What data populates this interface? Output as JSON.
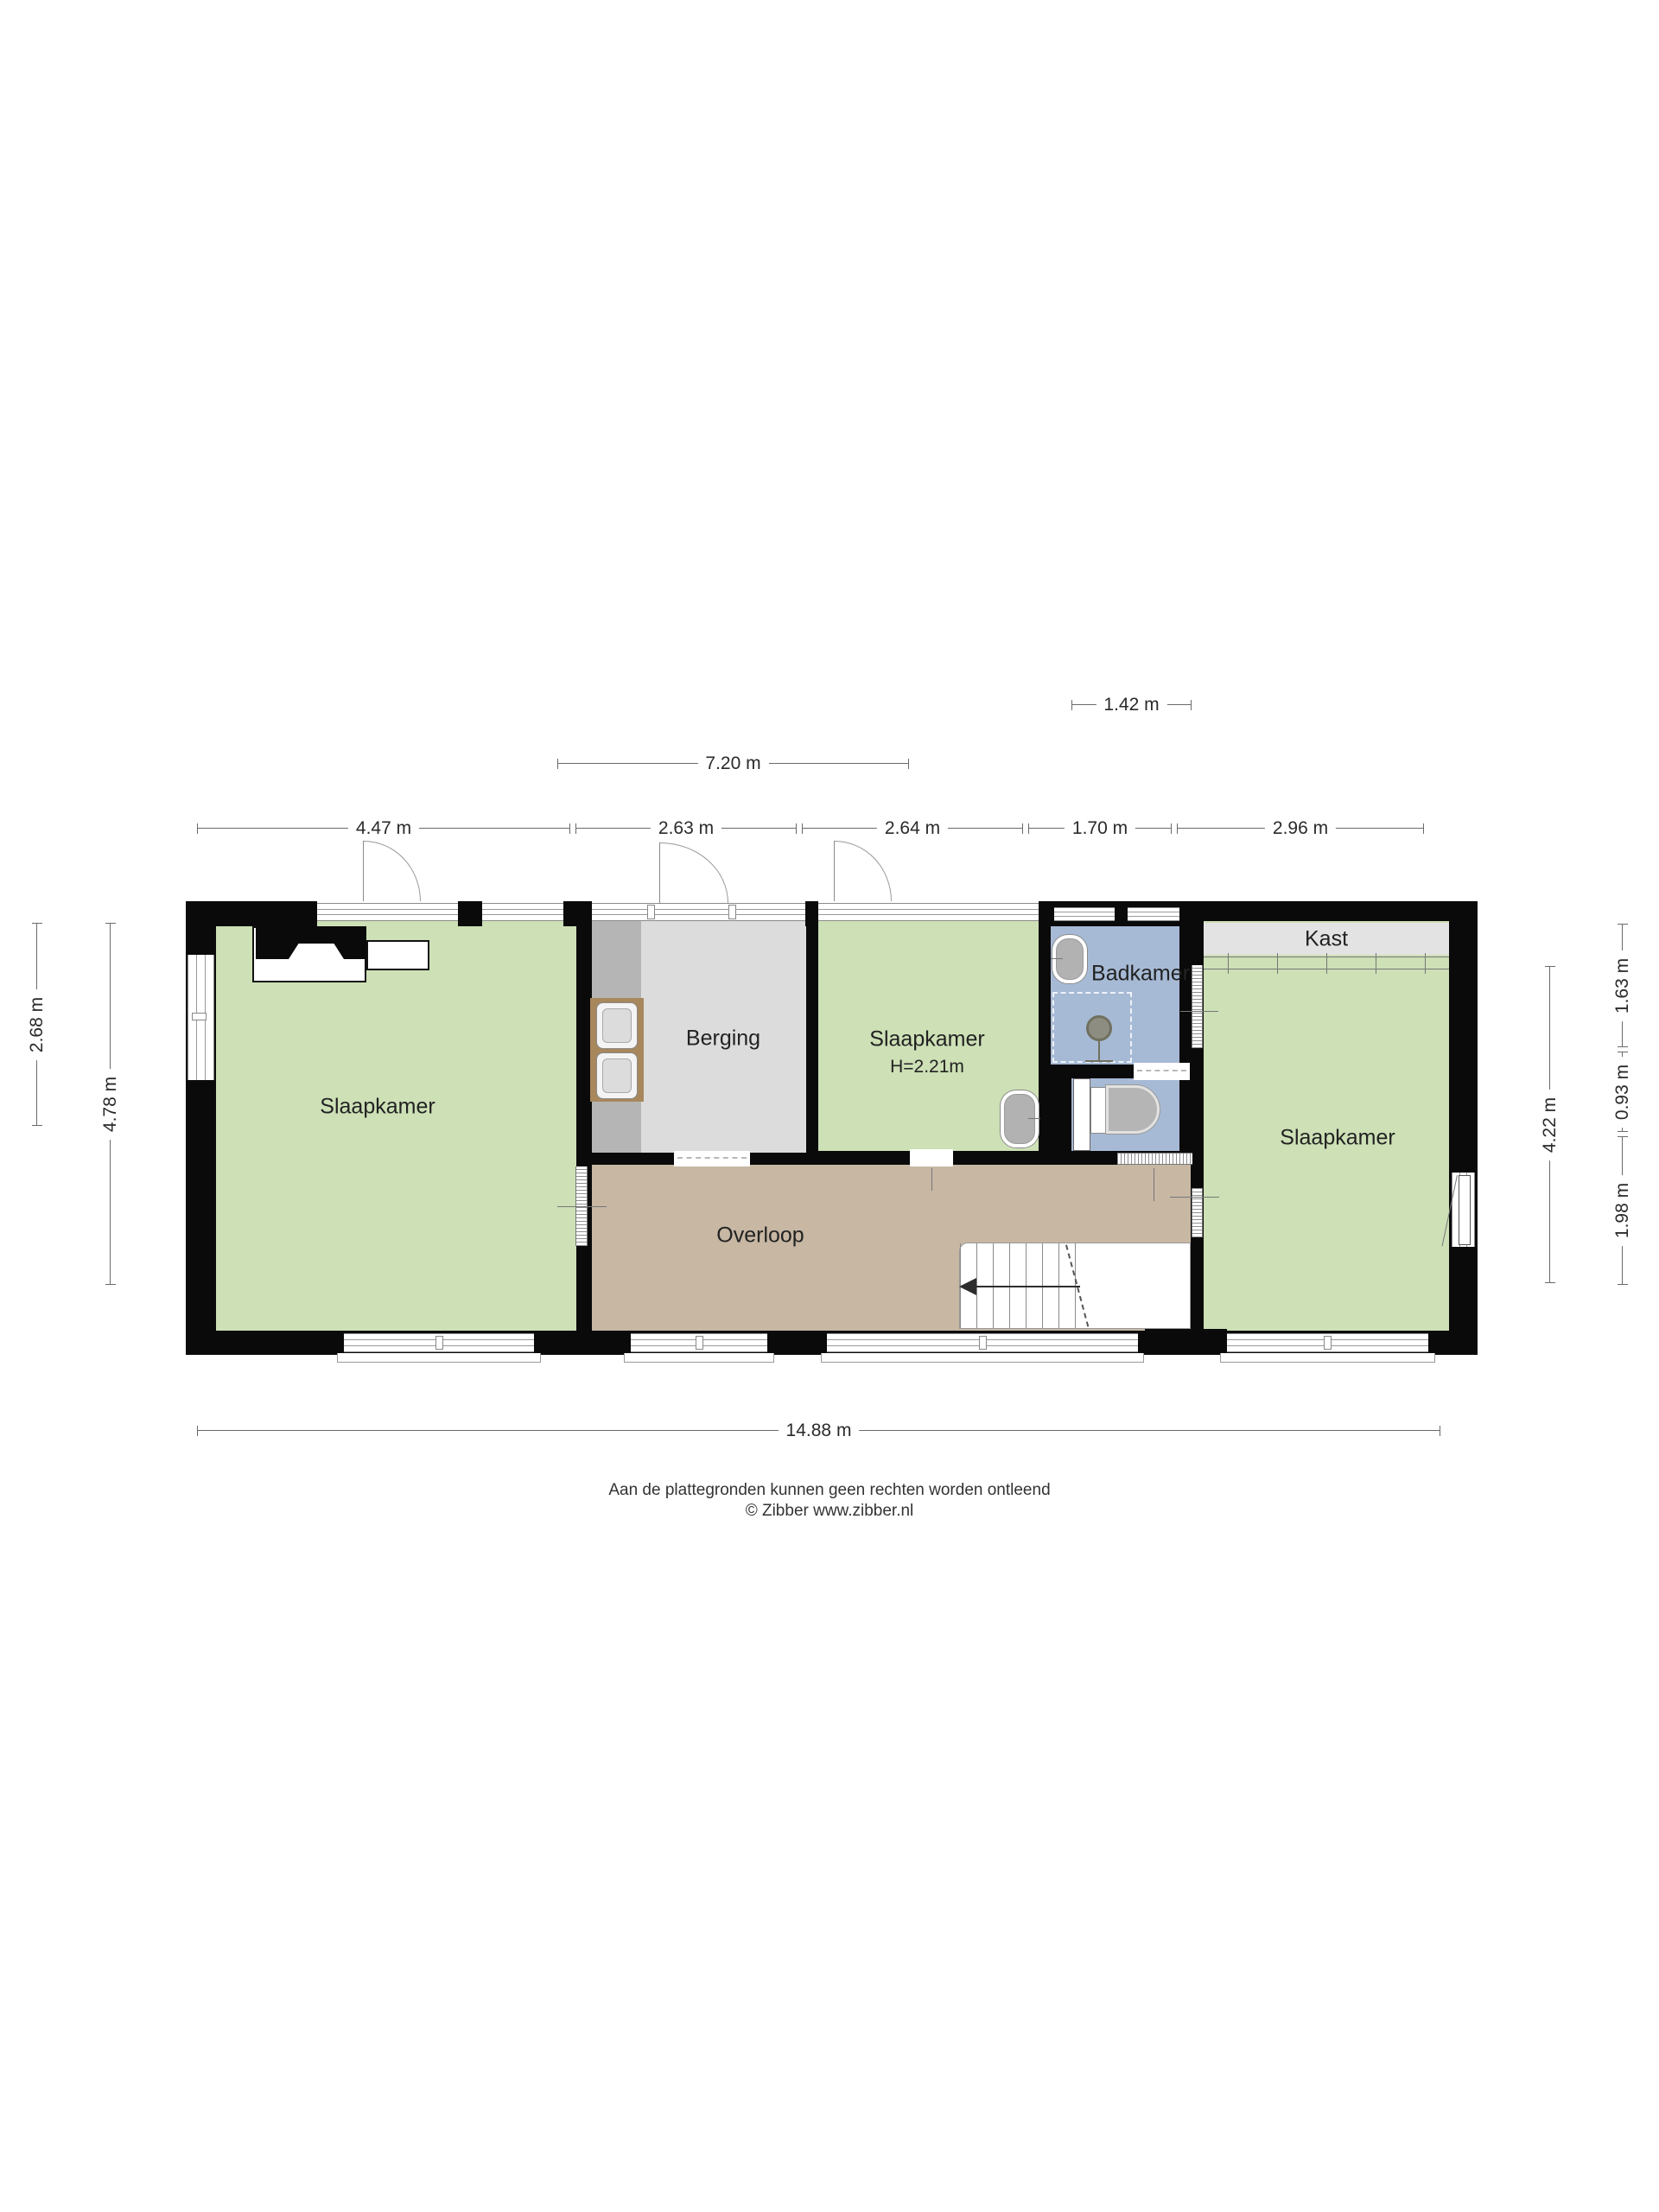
{
  "rooms": {
    "bedroom_left": {
      "label": "Slaapkamer"
    },
    "storage": {
      "label": "Berging"
    },
    "bedroom_middle": {
      "label": "Slaapkamer",
      "ceiling_height": "H=2.21m"
    },
    "bathroom": {
      "label": "Badkamer"
    },
    "closet": {
      "label": "Kast"
    },
    "bedroom_right": {
      "label": "Slaapkamer"
    },
    "landing": {
      "label": "Overloop"
    }
  },
  "dimensions": {
    "top_offset": "1.42 m",
    "top_span": "7.20 m",
    "top_sections": [
      "4.47 m",
      "2.63 m",
      "2.64 m",
      "1.70 m",
      "2.96 m"
    ],
    "bottom_total": "14.88 m",
    "left_upper": "2.68 m",
    "left_full": "4.78 m",
    "right_inner": "4.22 m",
    "right_sections": [
      "1.63 m",
      "0.93 m",
      "1.98 m"
    ]
  },
  "footer": {
    "disclaimer": "Aan de plattegronden kunnen geen rechten worden ontleend",
    "copyright": "© Zibber www.zibber.nl"
  },
  "colors": {
    "room_green": "#cde0b6",
    "bathroom_blue": "#a7bad5",
    "landing_tan": "#c7b7a3",
    "storage_gray": "#dcdcdc",
    "counter_gray": "#b5b5b5",
    "closet_gray": "#e3e3e3",
    "wall_black": "#0a0a0a",
    "dimension_gray": "#6a6a6a"
  }
}
